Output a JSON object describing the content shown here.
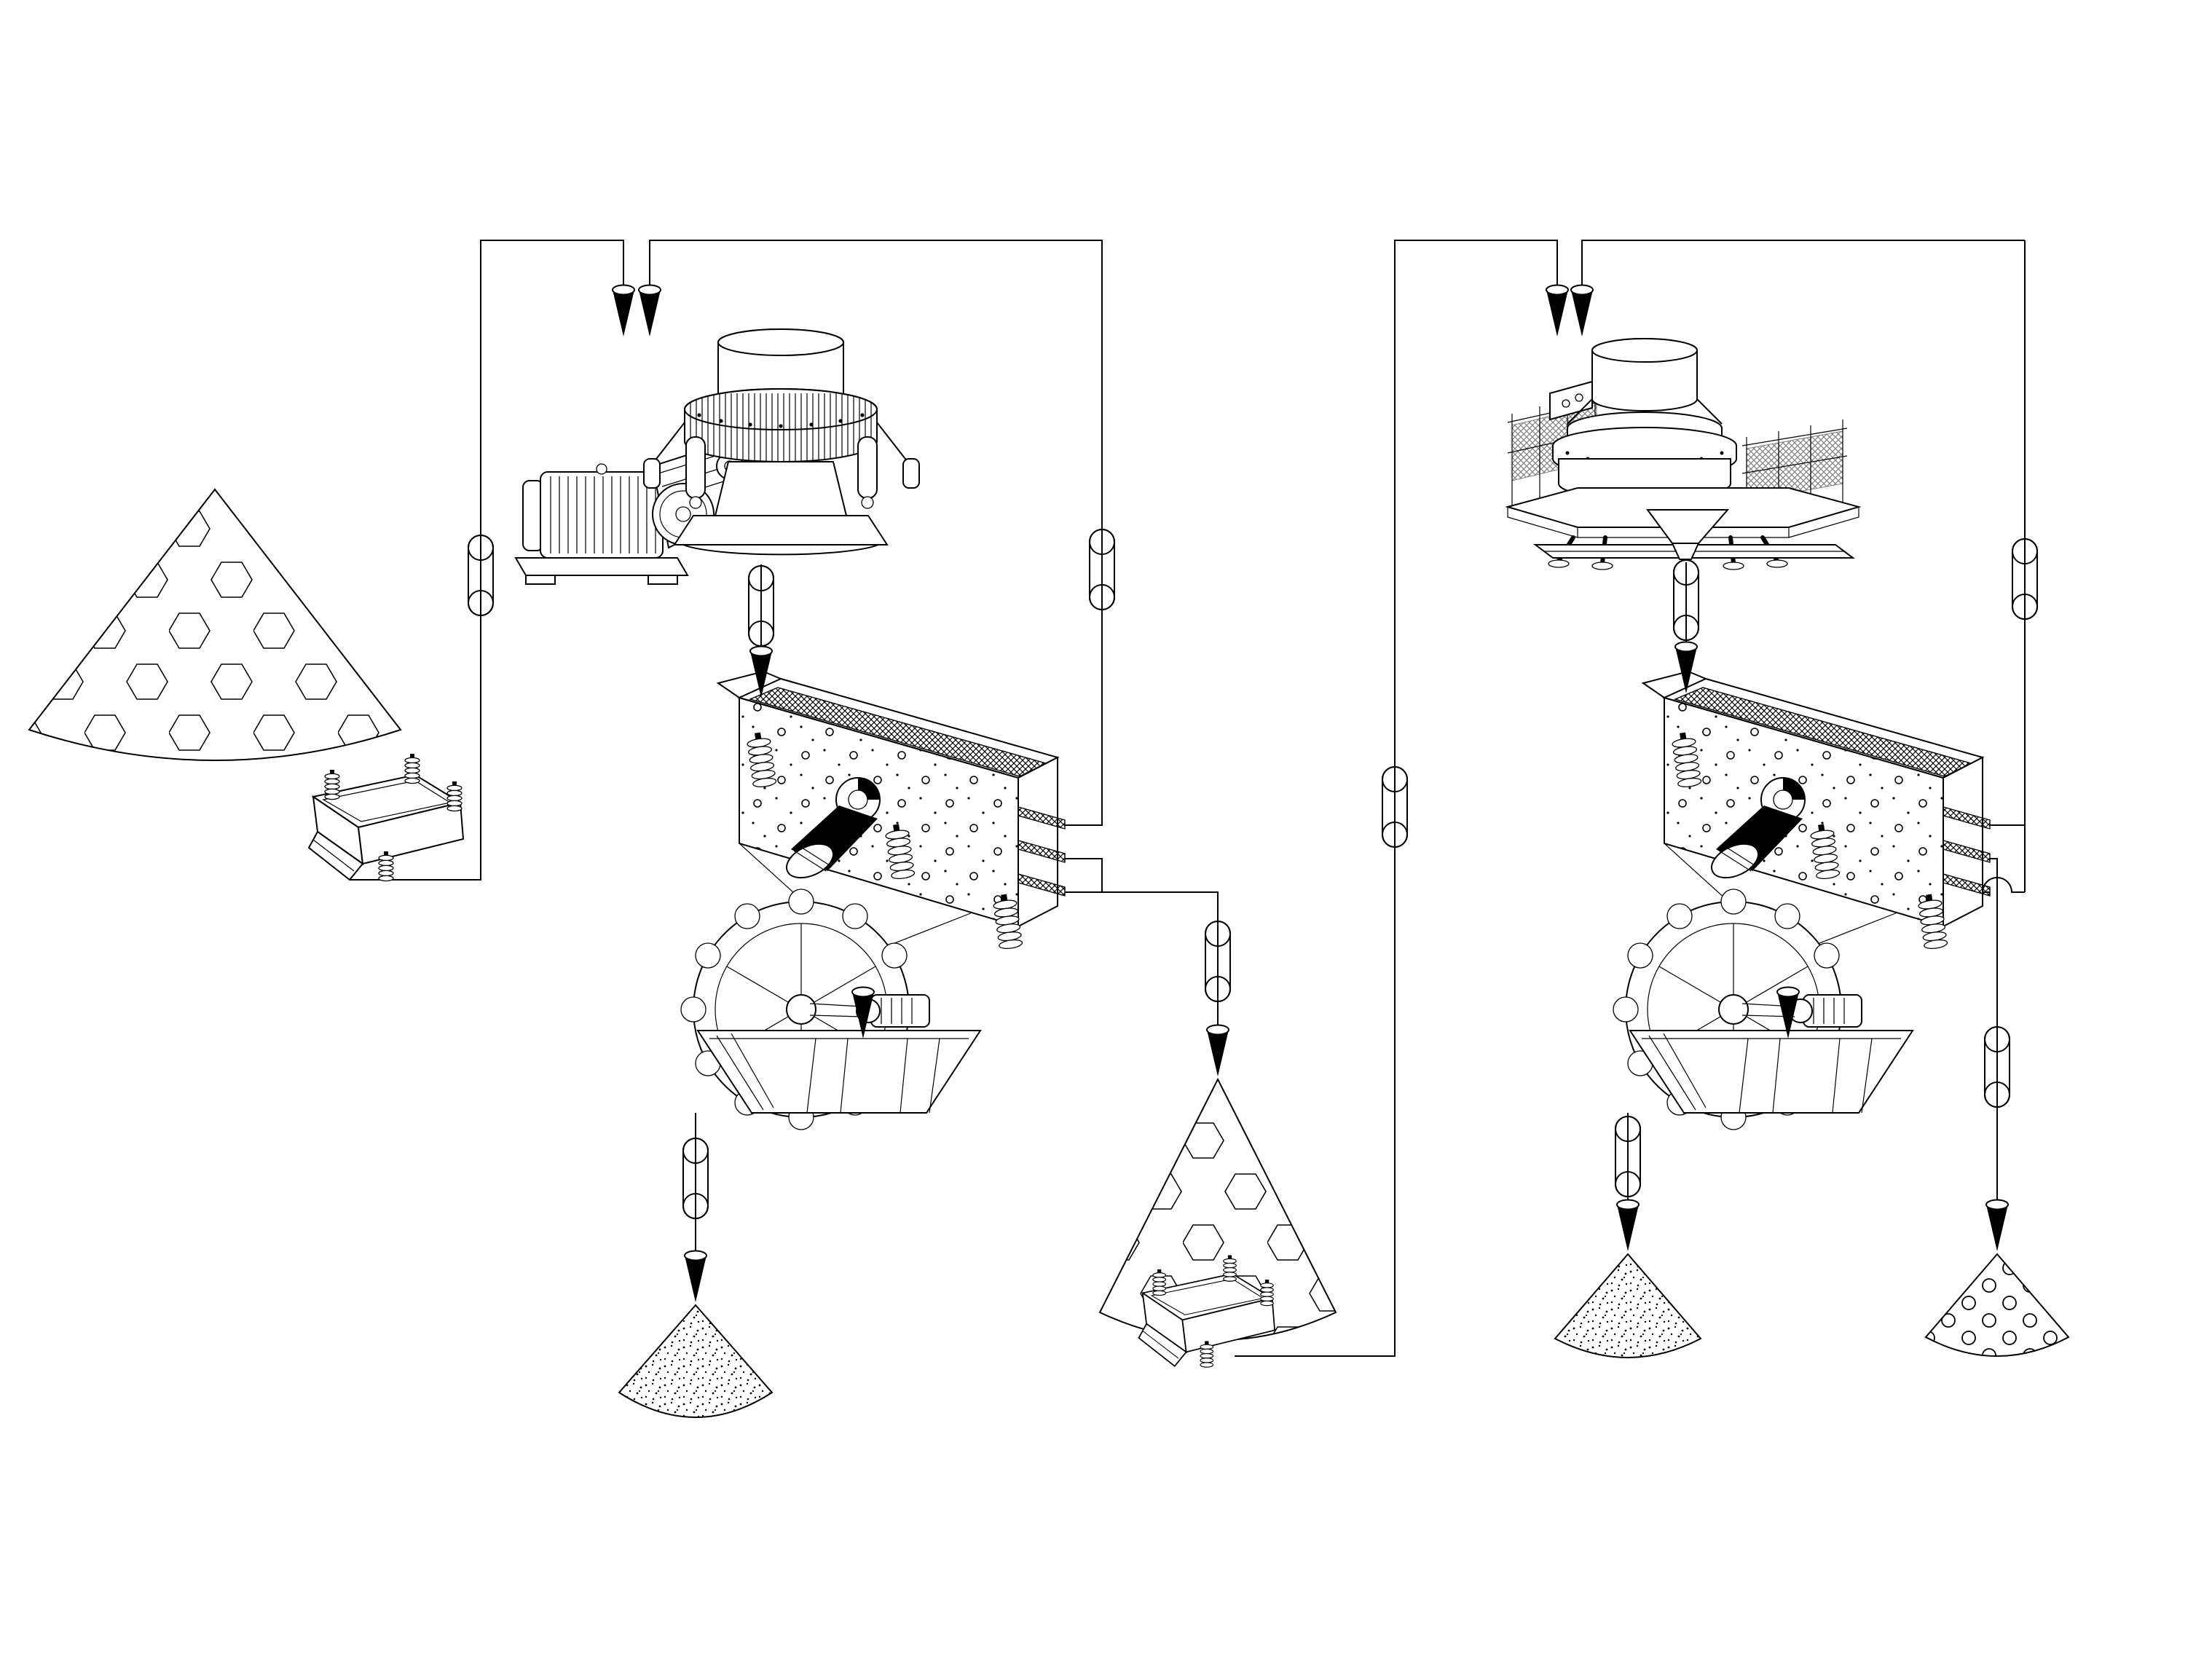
{
  "diagram": {
    "type": "process-flow-diagram",
    "subject": "Two-stage stone crushing and sand making plant flowsheet (line drawing, no text labels)",
    "background_color": "#ffffff",
    "line_color": "#000000",
    "equipment": [
      {
        "id": "raw-stockpile",
        "label": "coarse material stockpile (hexagon texture cone)",
        "type": "stockpile-hexagon",
        "stage": "crushing-line"
      },
      {
        "id": "vibrating-feeder-1",
        "label": "vibrating feeder under coarse stockpile",
        "type": "vibrating-feeder",
        "stage": "crushing-line"
      },
      {
        "id": "cone-crusher",
        "label": "cone crusher with electric motor and v-belt drive",
        "type": "cone-crusher",
        "stage": "crushing-line"
      },
      {
        "id": "vibrating-screen-1",
        "label": "triple-deck inclined vibrating screen",
        "type": "vibrating-screen",
        "stage": "crushing-line"
      },
      {
        "id": "sand-washer-1",
        "label": "bucket-wheel sand washer",
        "type": "sand-washer",
        "stage": "crushing-line"
      },
      {
        "id": "washed-sand-stockpile-1",
        "label": "washed sand stockpile (speckle texture cone)",
        "type": "stockpile-sand",
        "stage": "crushing-line"
      },
      {
        "id": "intermediate-stockpile",
        "label": "intermediate crushed stockpile (hexagon texture cone)",
        "type": "stockpile-hexagon",
        "stage": "transfer"
      },
      {
        "id": "vibrating-feeder-2",
        "label": "vibrating feeder under intermediate stockpile",
        "type": "vibrating-feeder",
        "stage": "transfer"
      },
      {
        "id": "vsi-crusher",
        "label": "vertical shaft impact sand making machine with platform and railings",
        "type": "vsi-crusher",
        "stage": "sand-making-line"
      },
      {
        "id": "vibrating-screen-2",
        "label": "triple-deck inclined vibrating screen",
        "type": "vibrating-screen",
        "stage": "sand-making-line"
      },
      {
        "id": "sand-washer-2",
        "label": "bucket-wheel sand washer",
        "type": "sand-washer",
        "stage": "sand-making-line"
      },
      {
        "id": "washed-sand-stockpile-2",
        "label": "washed sand stockpile (speckle texture cone)",
        "type": "stockpile-sand",
        "stage": "sand-making-line"
      },
      {
        "id": "aggregate-stockpile",
        "label": "graded fine aggregate stockpile (circle texture cone)",
        "type": "stockpile-gravel",
        "stage": "sand-making-line"
      }
    ],
    "flows": [
      {
        "from": "raw-stockpile",
        "to": "vibrating-feeder-1",
        "transport": "gravity"
      },
      {
        "from": "vibrating-feeder-1",
        "to": "cone-crusher",
        "transport": "belt-conveyor"
      },
      {
        "from": "cone-crusher",
        "to": "vibrating-screen-1",
        "transport": "belt-conveyor"
      },
      {
        "from": "vibrating-screen-1",
        "to": "cone-crusher",
        "transport": "belt-conveyor",
        "note": "top deck oversize recirculation"
      },
      {
        "from": "vibrating-screen-1",
        "to": "intermediate-stockpile",
        "transport": "belt-conveyor",
        "note": "middle and bottom deck product"
      },
      {
        "from": "vibrating-screen-1",
        "to": "sand-washer-1",
        "transport": "chute",
        "note": "screen underflow"
      },
      {
        "from": "sand-washer-1",
        "to": "washed-sand-stockpile-1",
        "transport": "belt-conveyor"
      },
      {
        "from": "intermediate-stockpile",
        "to": "vibrating-feeder-2",
        "transport": "gravity"
      },
      {
        "from": "vibrating-feeder-2",
        "to": "vsi-crusher",
        "transport": "belt-conveyor"
      },
      {
        "from": "vsi-crusher",
        "to": "vibrating-screen-2",
        "transport": "belt-conveyor"
      },
      {
        "from": "vibrating-screen-2",
        "to": "vsi-crusher",
        "transport": "belt-conveyor",
        "note": "top and bottom deck oversize recirculation with line jump-over arc"
      },
      {
        "from": "vibrating-screen-2",
        "to": "aggregate-stockpile",
        "transport": "belt-conveyor",
        "note": "middle deck product"
      },
      {
        "from": "vibrating-screen-2",
        "to": "sand-washer-2",
        "transport": "chute",
        "note": "screen underflow"
      },
      {
        "from": "sand-washer-2",
        "to": "washed-sand-stockpile-2",
        "transport": "belt-conveyor"
      }
    ],
    "symbols": {
      "conveyor_capsule_count": 10,
      "flow_arrow_count": 12,
      "line_jumpover_arc_count": 1
    }
  }
}
